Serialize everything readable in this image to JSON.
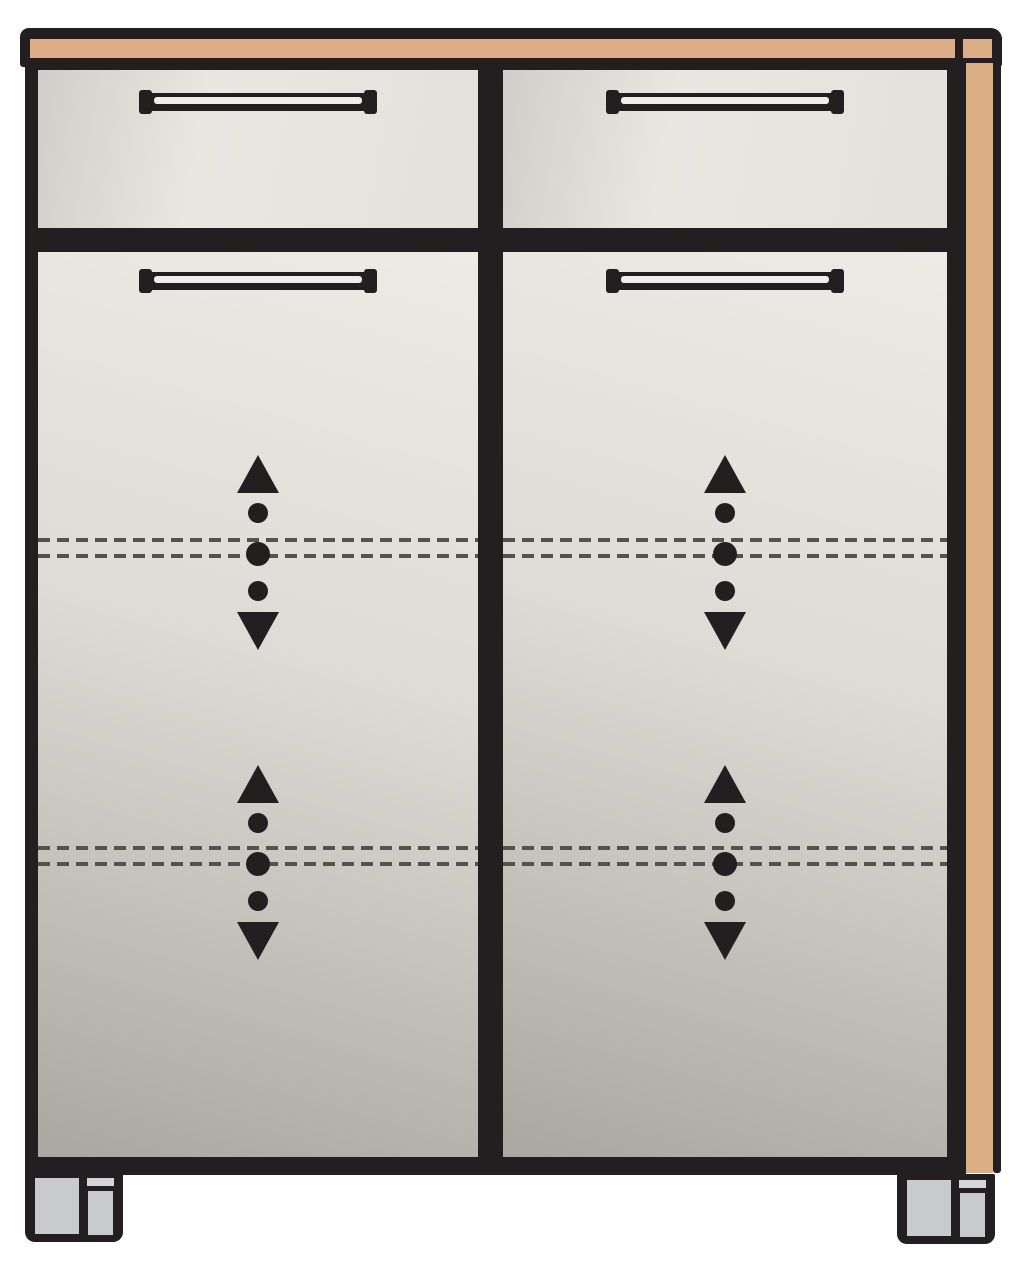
{
  "meta": {
    "title": "Cabinet front-view line diagram",
    "diagram_type": "furniture-illustration",
    "description": "Two-drawer, two-door cabinet with wood top and side trim, adjustable-shelf arrow markers and two front feet"
  },
  "colors": {
    "background": "#ffffff",
    "outline": "#231f20",
    "wood_trim": "#dcae85",
    "drawer_edge": "#d0cec8",
    "drawer_light": "#e9e7e2",
    "drawer_mid": "#e3e1db",
    "door_top": "#ecebe6",
    "door_mid": "#dddbd5",
    "door_bottom": "#a9a79f",
    "handle_slot": "#efede9",
    "dash_color": "#54524d",
    "foot_gray": "#c8cace",
    "foot_gray_light": "#d3d5d9"
  },
  "structure": {
    "trim": [
      {
        "id": "wood-top-strip"
      },
      {
        "id": "wood-top-end-cap"
      },
      {
        "id": "wood-side-strip"
      }
    ],
    "panels": [
      {
        "id": "drawer-front-top-left",
        "kind": "drawer",
        "handle": true
      },
      {
        "id": "drawer-front-top-right",
        "kind": "drawer",
        "handle": true
      },
      {
        "id": "door-left",
        "kind": "door",
        "handle": true,
        "shelf-marker-rows": 2
      },
      {
        "id": "door-right",
        "kind": "door",
        "handle": true,
        "shelf-marker-rows": 2
      }
    ],
    "shelf_marker_symbols": [
      "up-triangle",
      "dot",
      "dot",
      "dot",
      "down-triangle"
    ],
    "feet_count": 2
  },
  "layout": {
    "stage": {
      "w": 1024,
      "h": 1280
    },
    "cap": {
      "x": 20,
      "y": 28,
      "w": 982,
      "h": 39
    },
    "wood_top": {
      "x": 30,
      "y": 39,
      "w": 925,
      "h": 19
    },
    "wood_top_end": {
      "x": 963,
      "y": 39,
      "w": 29,
      "h": 19
    },
    "body": {
      "x": 25,
      "y": 63,
      "w": 941,
      "h": 1112
    },
    "wood_side": {
      "x": 966,
      "y": 63,
      "w": 27,
      "h": 1110
    },
    "side_edge": {
      "x": 993,
      "y": 63,
      "w": 8,
      "h": 1110
    },
    "faces": [
      {
        "id": "drawer-front-top-left",
        "kind": "drawer",
        "x": 38,
        "y": 70,
        "w": 440,
        "h": 158
      },
      {
        "id": "drawer-front-top-right",
        "kind": "drawer",
        "x": 503,
        "y": 70,
        "w": 444,
        "h": 158
      },
      {
        "id": "door-left",
        "kind": "door",
        "x": 38,
        "y": 252,
        "w": 440,
        "h": 905
      },
      {
        "id": "door-right",
        "kind": "door",
        "x": 503,
        "y": 252,
        "w": 444,
        "h": 905
      }
    ],
    "handle_size": {
      "w": 234,
      "h": 18
    },
    "handles": [
      {
        "id": "handle-drawer-left",
        "x": 141,
        "y": 93
      },
      {
        "id": "handle-drawer-right",
        "x": 608,
        "y": 93
      },
      {
        "id": "handle-door-left",
        "x": 141,
        "y": 272
      },
      {
        "id": "handle-door-right",
        "x": 608,
        "y": 272
      }
    ],
    "shelf_lines": [
      {
        "x": 38,
        "y": 538,
        "w": 440
      },
      {
        "x": 38,
        "y": 554,
        "w": 440
      },
      {
        "x": 503,
        "y": 538,
        "w": 444
      },
      {
        "x": 503,
        "y": 554,
        "w": 444
      },
      {
        "x": 38,
        "y": 846,
        "w": 440
      },
      {
        "x": 38,
        "y": 862,
        "w": 440
      },
      {
        "x": 503,
        "y": 846,
        "w": 444
      },
      {
        "x": 503,
        "y": 862,
        "w": 444
      }
    ],
    "indicator_offsets": {
      "tri_up": 0,
      "dot1": 48,
      "dot_big": 87,
      "dot2": 126,
      "tri_down": 157,
      "total_h": 195
    },
    "indicators": [
      {
        "id": "shelf-indicator-upper-left",
        "cx": 258,
        "top": 455
      },
      {
        "id": "shelf-indicator-upper-right",
        "cx": 725,
        "top": 455
      },
      {
        "id": "shelf-indicator-lower-left",
        "cx": 258,
        "top": 765
      },
      {
        "id": "shelf-indicator-lower-right",
        "cx": 725,
        "top": 765
      }
    ],
    "foot_size": {
      "w": 98,
      "h": 70
    },
    "feet": [
      {
        "id": "foot-left",
        "x": 25,
        "y": 1172
      },
      {
        "id": "foot-right",
        "x": 897,
        "y": 1174
      }
    ]
  }
}
